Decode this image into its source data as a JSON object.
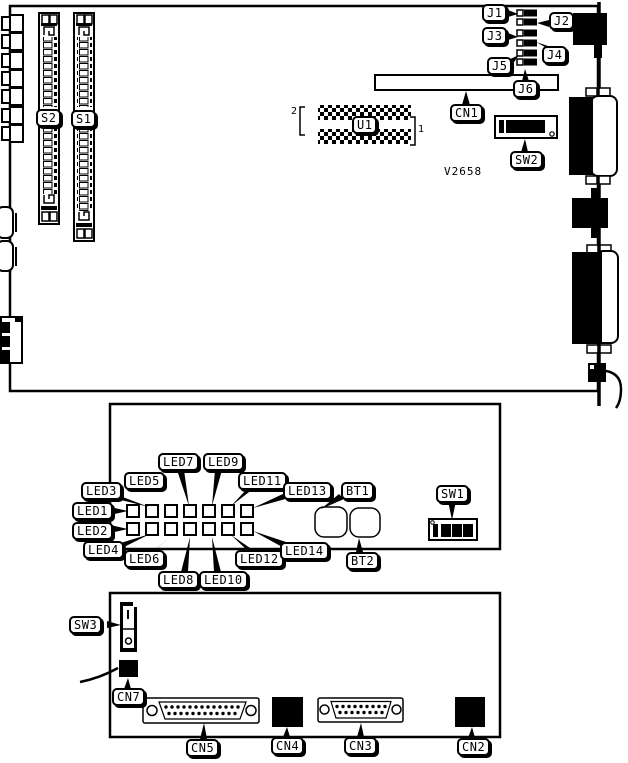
{
  "main_board": {
    "socket_labels": {
      "s2": "S2",
      "s1": "S1",
      "u1": "U1"
    },
    "pin_markers": {
      "pin2": "2",
      "pin1": "1"
    },
    "jumper_labels": [
      "J1",
      "J2",
      "J3",
      "J4",
      "J5",
      "J6"
    ],
    "connector_label": "CN1",
    "switch_label": "SW2",
    "part_number": "V2658"
  },
  "led_board": {
    "led_labels": [
      "LED1",
      "LED2",
      "LED3",
      "LED4",
      "LED5",
      "LED6",
      "LED7",
      "LED8",
      "LED9",
      "LED10",
      "LED11",
      "LED12",
      "LED13",
      "LED14"
    ],
    "button_labels": [
      "BT1",
      "BT2"
    ],
    "switch_label": "SW1"
  },
  "io_board": {
    "switch_label": "SW3",
    "connector_labels": {
      "cn7": "CN7",
      "cn5": "CN5",
      "cn4": "CN4",
      "cn3": "CN3",
      "cn2": "CN2"
    }
  },
  "colors": {
    "line": "#000000",
    "background": "#ffffff"
  }
}
